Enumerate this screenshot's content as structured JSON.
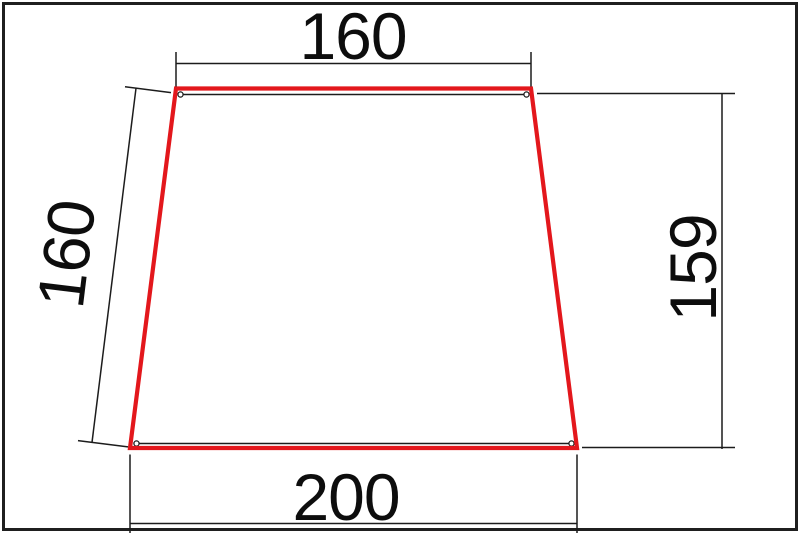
{
  "drawing": {
    "title": "dimensioned-trapezoid-drawing",
    "shape_type": "trapezoid",
    "outline_color": "#e3171c",
    "line_color": "#1c1c1c",
    "frame_color": "#1f1f1f",
    "dimensions": {
      "top": {
        "label": "160",
        "value": 160,
        "side": "top-width"
      },
      "left": {
        "label": "160",
        "value": 160,
        "side": "left-slant-length"
      },
      "right": {
        "label": "159",
        "value": 159,
        "side": "right-height"
      },
      "bottom": {
        "label": "200",
        "value": 200,
        "side": "bottom-width"
      }
    }
  }
}
